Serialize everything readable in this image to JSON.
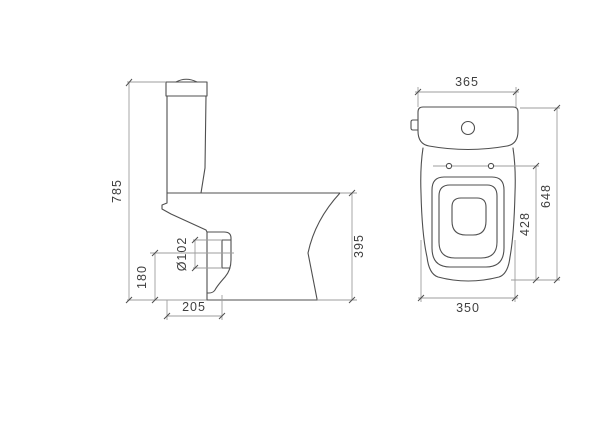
{
  "drawing": {
    "colors": {
      "background": "#ffffff",
      "line": "#4f4f4f",
      "dim": "#9e9e9e",
      "text": "#3f3f3f"
    },
    "side_view": {
      "overall_height": "785",
      "outlet_center_height": "180",
      "outlet_diameter": "Ø102",
      "outlet_setout": "205",
      "bowl_height": "395"
    },
    "front_view": {
      "cistern_width": "365",
      "overall_depth": "648",
      "seat_length": "428",
      "bowl_width": "350"
    }
  }
}
